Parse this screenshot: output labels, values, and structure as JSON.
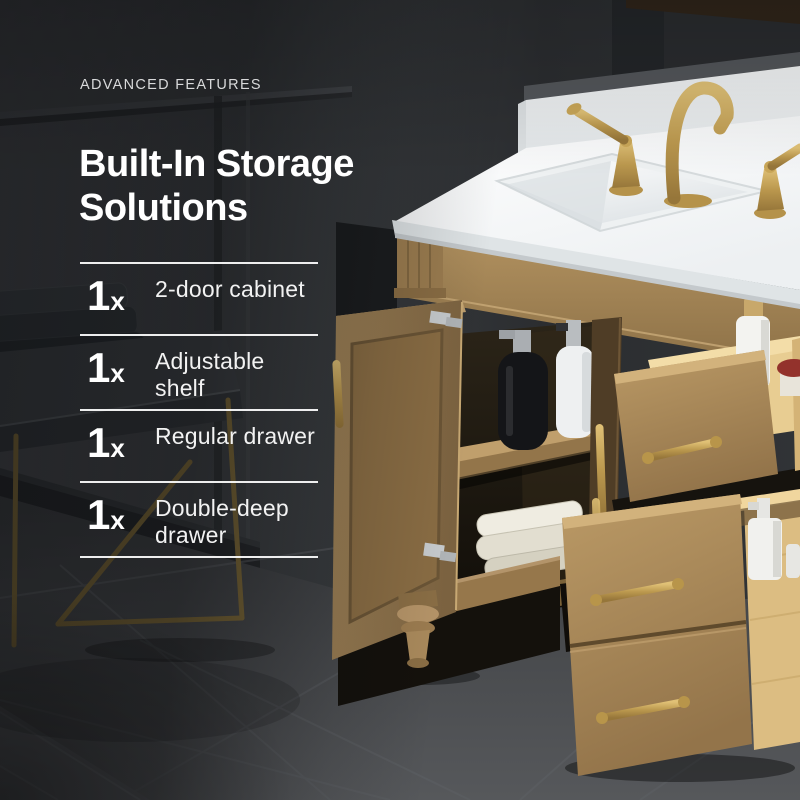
{
  "page": {
    "eyebrow": "ADVANCED FEATURES",
    "title_line1": "Built-In Storage",
    "title_line2": "Solutions"
  },
  "features": {
    "items": [
      {
        "qty_number": "1",
        "qty_suffix": "x",
        "name": "2-door cabinet"
      },
      {
        "qty_number": "1",
        "qty_suffix": "x",
        "name": "Adjustable shelf"
      },
      {
        "qty_number": "1",
        "qty_suffix": "x",
        "name": "Regular drawer"
      },
      {
        "qty_number": "1",
        "qty_suffix": "x",
        "name": "Double-deep drawer"
      }
    ]
  },
  "colors": {
    "wall": "#3a3d40",
    "wall_dark": "#2a2c2f",
    "floor": "#46484b",
    "wood": "#a98a5e",
    "wood_light": "#ddbf86",
    "gold_hardware": "#c2a157",
    "countertop": "#f6f8f9",
    "text": "#ffffff"
  }
}
